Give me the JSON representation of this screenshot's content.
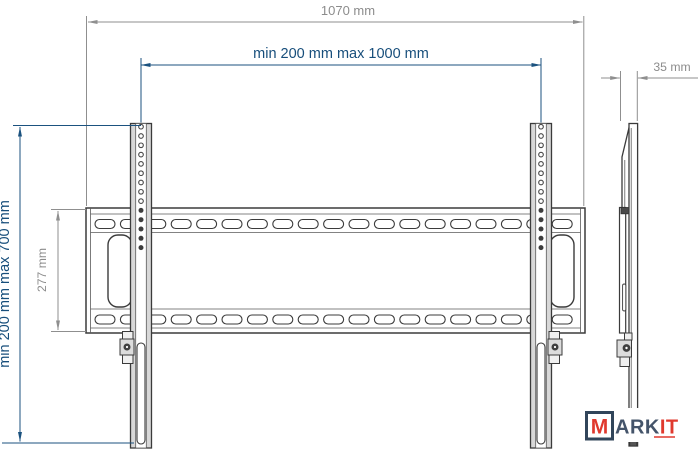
{
  "page": {
    "background_color": "#ffffff"
  },
  "colors": {
    "dimension_gray": "#8c8c8c",
    "dimension_blue": "#174e7b",
    "drawing_line": "#3b3b3b",
    "bracket_fill": "#d8d8d8",
    "logo_red": "#e0392e",
    "logo_navy": "#44546a",
    "logo_box_border": "#31455a"
  },
  "diagram": {
    "type": "technical-drawing",
    "subject": "TV wall mount bracket",
    "dimensions": [
      {
        "id": "overall-width",
        "label": "1070 mm",
        "orientation": "horizontal",
        "color": "gray"
      },
      {
        "id": "vesa-width",
        "label": "min 200 mm max 1000 mm",
        "orientation": "horizontal",
        "color": "blue"
      },
      {
        "id": "vesa-height",
        "label": "min 200 mm max 700 mm",
        "orientation": "vertical",
        "color": "blue"
      },
      {
        "id": "plate-height",
        "label": "277 mm",
        "orientation": "vertical",
        "color": "gray"
      },
      {
        "id": "profile-depth",
        "label": "35 mm",
        "orientation": "horizontal",
        "color": "gray"
      }
    ],
    "logo": {
      "m": "M",
      "ark": "ARK",
      "it": "IT"
    }
  }
}
